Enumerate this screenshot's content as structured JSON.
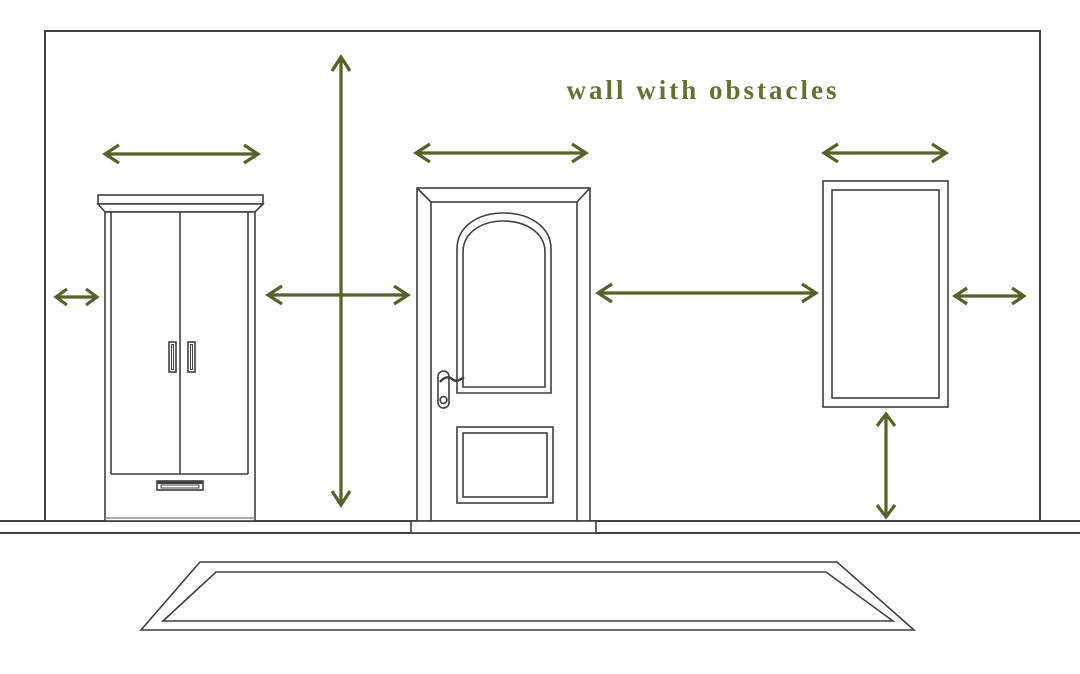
{
  "diagram": {
    "title": "wall with obstacles",
    "objects": [
      {
        "name": "wall"
      },
      {
        "name": "floor"
      },
      {
        "name": "wardrobe"
      },
      {
        "name": "door"
      },
      {
        "name": "mirror"
      },
      {
        "name": "rug"
      }
    ],
    "arrows": [
      {
        "name": "wardrobe-width-arrow",
        "orientation": "horizontal"
      },
      {
        "name": "wall-height-arrow",
        "orientation": "vertical"
      },
      {
        "name": "door-width-arrow",
        "orientation": "horizontal"
      },
      {
        "name": "mirror-width-arrow",
        "orientation": "horizontal"
      },
      {
        "name": "left-edge-gap-arrow",
        "orientation": "horizontal"
      },
      {
        "name": "wardrobe-door-gap-arrow",
        "orientation": "horizontal"
      },
      {
        "name": "door-mirror-gap-arrow",
        "orientation": "horizontal"
      },
      {
        "name": "right-edge-gap-arrow",
        "orientation": "horizontal"
      },
      {
        "name": "mirror-floor-gap-arrow",
        "orientation": "vertical"
      }
    ]
  },
  "colors": {
    "accent": "#56622a",
    "title": "#66702f",
    "line": "#3f3f3f",
    "line_soft": "#8f8f8f",
    "background": "#ffffff"
  }
}
